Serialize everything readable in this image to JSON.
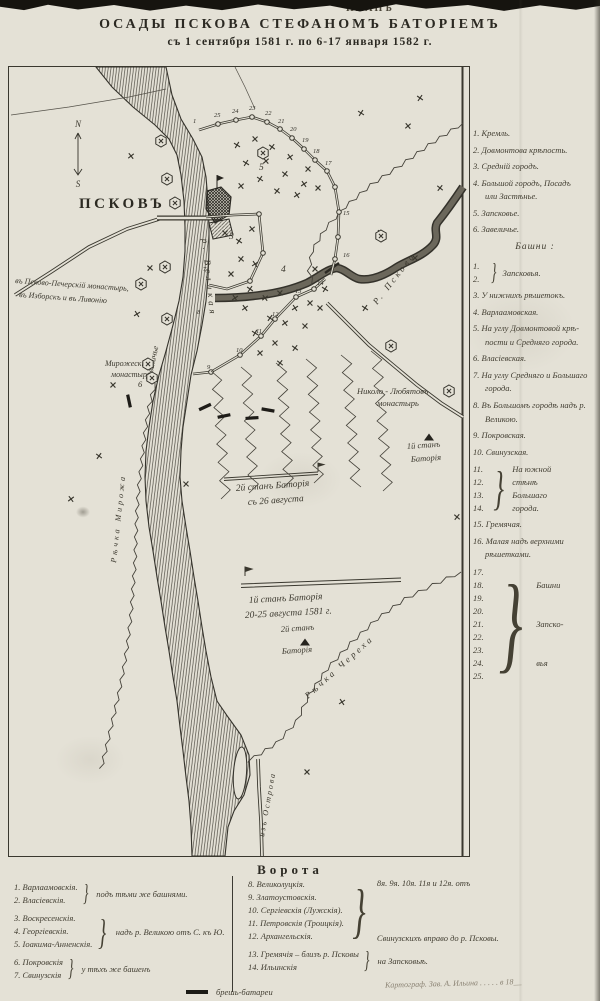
{
  "page": {
    "torn_label": "ПЛАНЪ",
    "title1": "ОСАДЫ ПСКОВА СТЕФАНОМЪ БАТОРІЕМЪ",
    "title2": "съ 1 сентября 1581 г. по 6-17 января 1582 г."
  },
  "map": {
    "city": "ПСКОВЪ",
    "compass": {
      "n": "N",
      "s": "S"
    },
    "labels": {
      "road1": "въ Псково-Печерскій монастырь,",
      "road2": "въ Изборскъ и въ Ливонію",
      "zavelichye_num": "6",
      "zavelichye": "Завеличье",
      "mirozh1": "Мирожескій",
      "mirozh2": "монастырь",
      "nikolo1": "Николо - Любятовъ",
      "nikolo2": "монастырь",
      "stan_ne1": "1й станъ",
      "stan_ne2": "Баторія",
      "stan_mid1": "2й станъ Баторія",
      "stan_mid2": "съ 26 августа",
      "stan_s1": "1й станъ Баторія",
      "stan_s2": "20-25 августа 1581 г.",
      "stan_s3": "2й станъ",
      "stan_s4": "Баторія",
      "r_velikaya": "р. Великая",
      "r_pskova": "Р. Пскова",
      "r_mirozha": "Рѣчка Мирожа",
      "r_cherekha": "Рѣчка Череха",
      "iz_ostrova": "изъ Острова",
      "area3": "3",
      "area4": "4",
      "area5": "5"
    },
    "tower_numbers": [
      "1",
      "25",
      "24",
      "23",
      "22",
      "21",
      "20",
      "19",
      "18",
      "17",
      "16",
      "15",
      "14",
      "13",
      "12",
      "11",
      "10",
      "9",
      "8",
      "7"
    ]
  },
  "legend": {
    "parts": [
      {
        "text": "1. Кремль."
      },
      {
        "text": "2. Довмонтова крѣпость."
      },
      {
        "text": "3. Средній городъ."
      },
      {
        "text": "4. Большой городъ, Посадъ",
        "cont": [
          "или Застѣнье."
        ]
      },
      {
        "text": "5. Запсковье."
      },
      {
        "text": "6. Завеличье."
      }
    ],
    "towers_header": "Башни :",
    "towers": [
      {
        "nums": [
          "1.",
          "2."
        ],
        "lines": [
          "Запсковья."
        ]
      },
      {
        "text": "3. У нижнихъ рѣшетокъ."
      },
      {
        "text": "4. Варлаамовская."
      },
      {
        "text": "5. На углу Довмонтовой крѣ-",
        "cont": [
          "пости и Средняго города."
        ]
      },
      {
        "text": "6. Власіевская."
      },
      {
        "text": "7. На углу Средняго и Большаго",
        "cont": [
          "города."
        ]
      },
      {
        "text": "8. Въ Большомъ городѣ надъ р.",
        "cont": [
          "Великою."
        ]
      },
      {
        "text": "9. Покровская."
      },
      {
        "text": "10. Свинузская."
      },
      {
        "nums": [
          "11.",
          "12.",
          "13.",
          "14."
        ],
        "lines": [
          "На южной",
          "стѣнѣ",
          "Большаго",
          "города."
        ]
      },
      {
        "text": "15. Гремячая."
      },
      {
        "text": "16. Малая надъ верхними",
        "cont": [
          "рѣшетками."
        ]
      },
      {
        "nums": [
          "17.",
          "18.",
          "19.",
          "20.",
          "21.",
          "22.",
          "23.",
          "24.",
          "25."
        ],
        "lines": [
          "Башни",
          "Запско-",
          "вья"
        ]
      }
    ]
  },
  "gates": {
    "header": "Ворота",
    "left": [
      {
        "items": [
          "1. Варлаамовскія.",
          "2. Власіевскія."
        ],
        "note": "подъ тѣми же башнями."
      },
      {
        "items": [
          "3. Воскресенскія.",
          "4. Георгіевскія.",
          "5. Іоакима-Анненскія."
        ],
        "note": "надъ р. Великою отъ С. къ Ю."
      },
      {
        "items": [
          "6. Покровскія",
          "7. Свинузскія"
        ],
        "note": "у тѣхъ же башенъ"
      }
    ],
    "right": [
      {
        "items": [
          "8. Великолуцкія.",
          "9. Златоустовскія.",
          "10. Сергіевскія (Лужскія).",
          "11. Петровскія (Троицкія).",
          "12. Архангельскія."
        ],
        "note_top": "8я. 9я. 10я. 11я и 12я. отъ",
        "note_bottom": "Свинузскихъ вправо до р. Псковы."
      },
      {
        "items": [
          "13. Гремячія – близъ р. Псковы",
          "14. Ильинскія"
        ],
        "note": "на Запсковьѣ."
      }
    ],
    "battery_legend": "брешь-батареи",
    "signature": "Картограф. Зав. А. Ильина . . . . . в 18__"
  }
}
